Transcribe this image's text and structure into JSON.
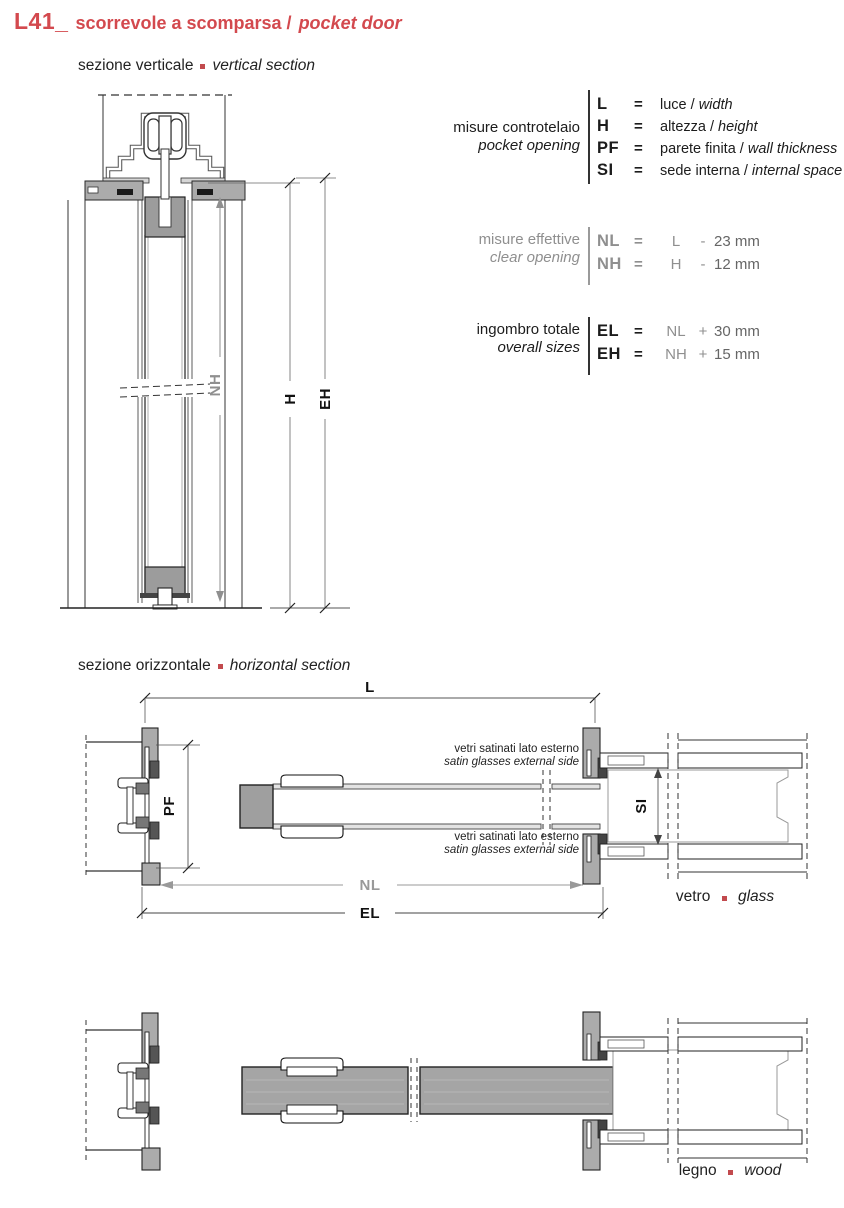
{
  "header": {
    "code": "L41_",
    "title_it": "scorrevole a scomparsa /",
    "title_en": "pocket door"
  },
  "sections": {
    "vertical": {
      "label_it": "sezione verticale",
      "label_en": "vertical section"
    },
    "horizontal": {
      "label_it": "sezione orizzontale",
      "label_en": "horizontal section"
    }
  },
  "legend": {
    "pocket_opening": {
      "label_it": "misure controtelaio",
      "label_en": "pocket opening",
      "rows": [
        {
          "key": "L",
          "eq": "=",
          "it": "luce /",
          "en": "width"
        },
        {
          "key": "H",
          "eq": "=",
          "it": "altezza /",
          "en": "height"
        },
        {
          "key": "PF",
          "eq": "=",
          "it": "parete finita /",
          "en": "wall thickness"
        },
        {
          "key": "SI",
          "eq": "=",
          "it": "sede interna /",
          "en": "internal space"
        }
      ]
    },
    "clear_opening": {
      "label_it": "misure effettive",
      "label_en": "clear opening",
      "rows": [
        {
          "key": "NL",
          "eq": "=",
          "base": "L",
          "op": "-",
          "value": "23 mm"
        },
        {
          "key": "NH",
          "eq": "=",
          "base": "H",
          "op": "-",
          "value": "12 mm"
        }
      ]
    },
    "overall_sizes": {
      "label_it": "ingombro totale",
      "label_en": "overall sizes",
      "rows": [
        {
          "key": "EL",
          "eq": "=",
          "base": "NL",
          "op": "+",
          "value": "30 mm"
        },
        {
          "key": "EH",
          "eq": "=",
          "base": "NH",
          "op": "+",
          "value": "15 mm"
        }
      ]
    }
  },
  "drawings": {
    "vertical_dims": {
      "nh": "NH",
      "h": "H",
      "eh": "EH"
    },
    "horizontal_dims": {
      "l": "L",
      "pf": "PF",
      "si": "SI",
      "nl": "NL",
      "el": "EL"
    },
    "glass_note_line1": "vetri satinati lato esterno",
    "glass_note_line2": "satin glasses external side",
    "glass_caption_it": "vetro",
    "glass_caption_en": "glass",
    "wood_caption_it": "legno",
    "wood_caption_en": "wood"
  },
  "colors": {
    "accent": "#d3494e",
    "dim_gray": "#8f8f8f",
    "ink": "#1c1c1c",
    "panel_gray": "#ababab"
  }
}
